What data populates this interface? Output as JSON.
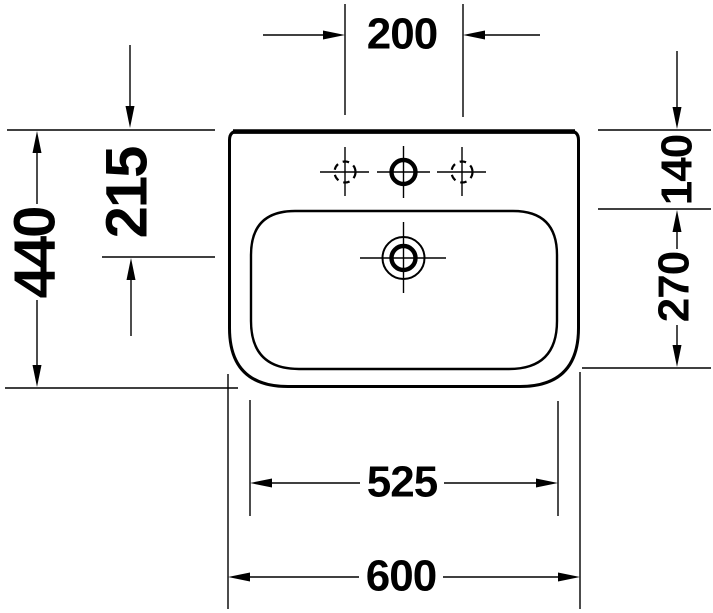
{
  "drawing": {
    "type": "washbasin-technical-dimension-drawing",
    "background_color": "#ffffff",
    "line_color": "#000000",
    "dimensions": {
      "tap_hole_spacing": "200",
      "back_to_overflow": "215",
      "overall_depth": "440",
      "back_to_basin_front": "140",
      "basin_inner_depth": "270",
      "basin_inner_width": "525",
      "overall_width": "600"
    }
  }
}
